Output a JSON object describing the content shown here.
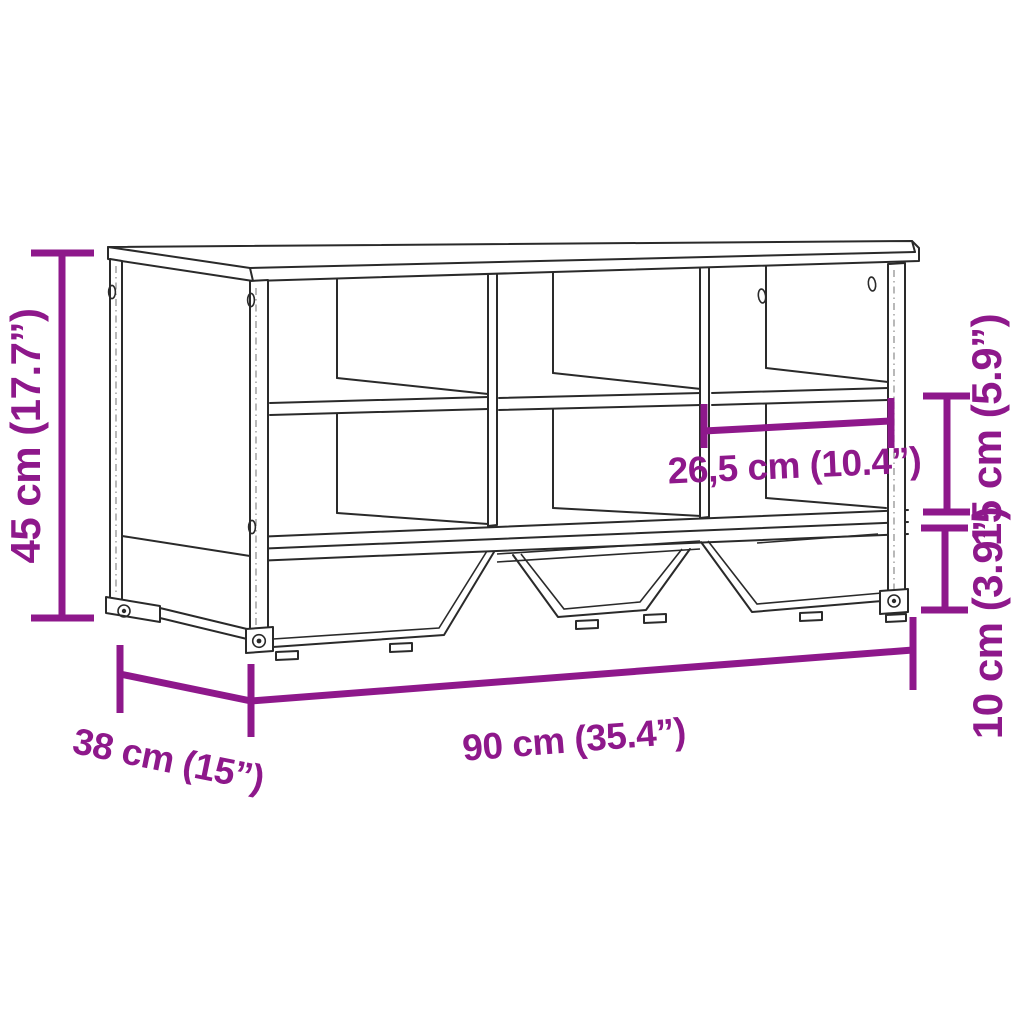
{
  "page": {
    "background": "#ffffff",
    "description_visible_content": "isometric line drawing of a 6-compartment shoe bench with metal sled legs and six dimension annotations"
  },
  "colors": {
    "dimension": "#8e188b",
    "line": "#2a2a2a",
    "background": "#ffffff"
  },
  "dimensions": {
    "height": {
      "label": "45 cm (17.7”)",
      "value_cm": "45",
      "value_in": "17.7"
    },
    "depth": {
      "label": "38 cm (15”)",
      "value_cm": "38",
      "value_in": "15"
    },
    "width": {
      "label": "90 cm (35.4”)",
      "value_cm": "90",
      "value_in": "35.4"
    },
    "inner_width": {
      "label": "26,5 cm (10.4”)",
      "value_cm": "26,5",
      "value_in": "10.4"
    },
    "upper_clearance": {
      "label": "15 cm (5.9”)",
      "value_cm": "15",
      "value_in": "5.9"
    },
    "lower_clearance": {
      "label": "10 cm (3.9”)",
      "value_cm": "10",
      "value_in": "3.9"
    }
  }
}
